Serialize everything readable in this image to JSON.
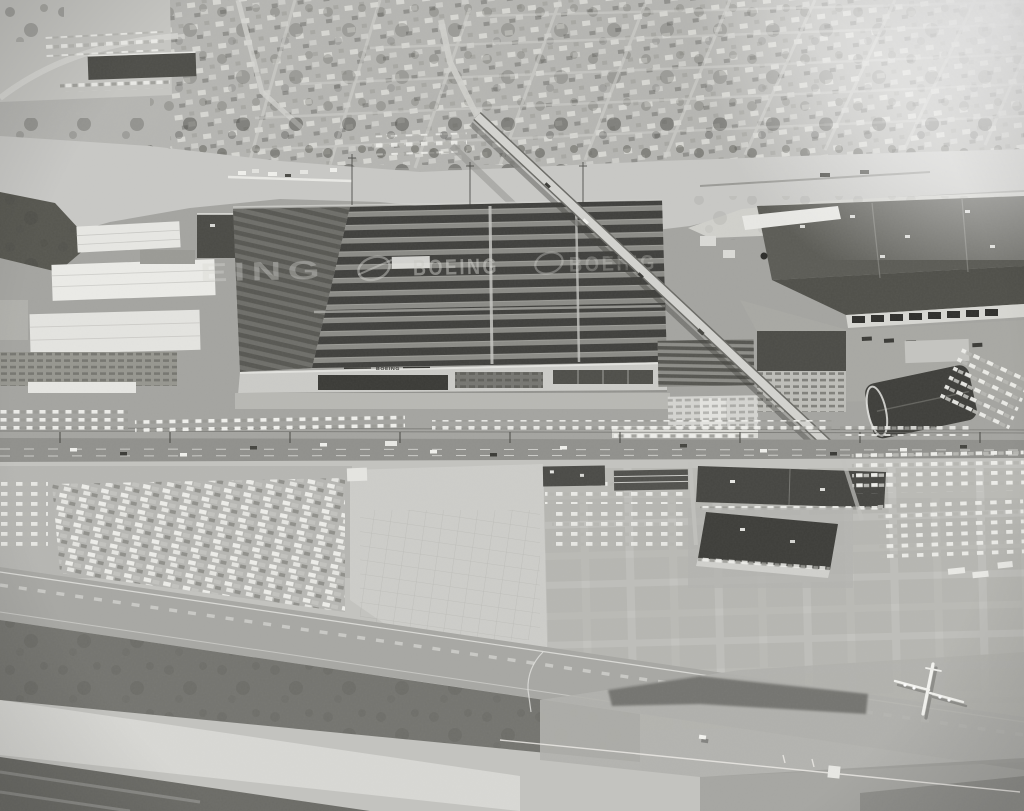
{
  "image": {
    "subject": "Black-and-white oblique aerial photograph of the Boeing Plant 2 factory complex beside a river, with a residential neighborhood across the water, a bridge, employee parking lots full of cars, and an airfield runway with a four-engine jet in the foreground"
  },
  "texts": {
    "roof_watermark_left": "EING",
    "roof_watermark_center": "BOEING",
    "roof_watermark_right": "BOEING",
    "facade_sign": "BOEING"
  },
  "palette": {
    "neighborhood": "#b6b6b2",
    "river": "#c8c8c5",
    "factory_ground": "#a4a4a0",
    "plant_roof": "#8b8b86",
    "tarmac": "#c3c3bf",
    "road": "#90908c",
    "monitor_stripe": "#3b3b38",
    "white_roof": "#e9e9e5",
    "warehouse_roof": "#55554f",
    "runway_dark": "#74746f",
    "runway_light": "#d8d8d4"
  }
}
